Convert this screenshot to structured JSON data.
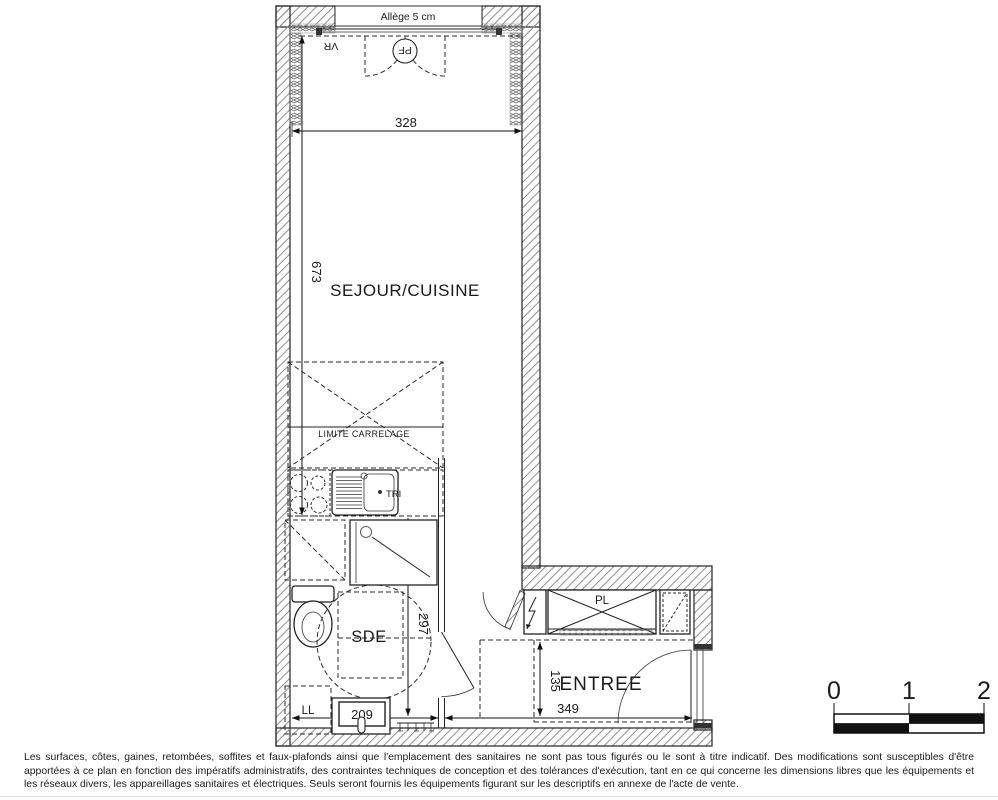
{
  "floor_plan": {
    "window_label": "Allège 5 cm",
    "shutter_label": "VR",
    "french_window_label": "PF",
    "rooms": {
      "sejour_cuisine": "SEJOUR/CUISINE",
      "sde": "SDE",
      "entree": "ENTREE"
    },
    "annotations": {
      "tiling_limit": "LIMITE CARRELAGE",
      "waste_sorting": "TRI",
      "closet": "PL",
      "washing_machine": "LL"
    },
    "dimensions_cm": {
      "sejour_width": "328",
      "sejour_length": "673",
      "sde_length": "297",
      "sde_width": "209",
      "entree_depth": "135",
      "entree_width": "349"
    }
  },
  "scale_bar": {
    "tick_0": "0",
    "tick_1": "1",
    "tick_2": "2"
  },
  "colors": {
    "line": "#1a1a1a",
    "wall_hatch_gray": "#8f8f8f"
  },
  "disclaimer": "Les surfaces, côtes, gaines, retombées, soffites et faux-plafonds ainsi que l'emplacement des sanitaires ne sont pas tous figurés ou le sont à titre indicatif. Des modifications sont susceptibles d'être apportées à ce plan en fonction des impératifs administratifs, des contraintes techniques de conception et des tolérances d'exécution, tant en ce qui concerne les dimensions libres que les équipements et les réseaux divers, les appareillages sanitaires et électriques. Seuls seront fournis les équipements figurant sur les descriptifs en annexe de l'acte de vente."
}
